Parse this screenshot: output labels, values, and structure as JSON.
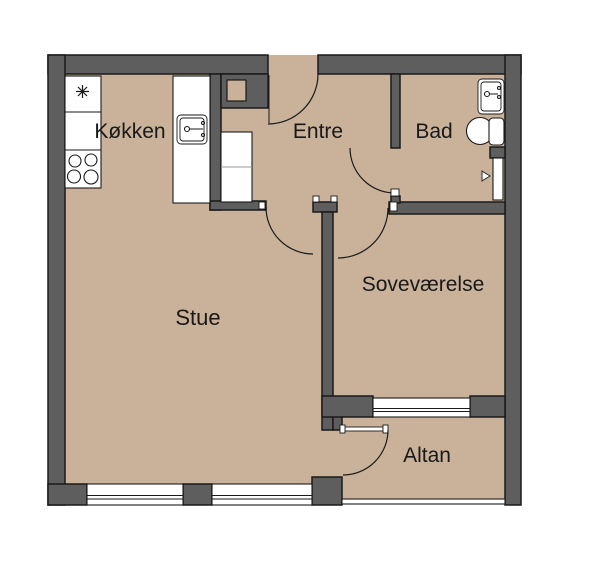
{
  "plan": {
    "type": "apartment-floor-plan",
    "language": "Danish",
    "rooms": [
      {
        "id": "kokken",
        "label": "Køkken"
      },
      {
        "id": "entre",
        "label": "Entre"
      },
      {
        "id": "bad",
        "label": "Bad"
      },
      {
        "id": "stue",
        "label": "Stue"
      },
      {
        "id": "sovevaerelse",
        "label": "Soveværelse"
      },
      {
        "id": "altan",
        "label": "Altan"
      }
    ],
    "fixtures": [
      "fridge-freezer-star-icon",
      "stove-burners-icon",
      "kitchen-sink-icon",
      "kitchen-counters",
      "entre-wardrobe",
      "duct-shaft",
      "entrance-door-swing",
      "bath-door-swing",
      "living-room-door-swing",
      "bedroom-door-swing",
      "balcony-door-swing",
      "bath-sink-icon",
      "toilet-icon",
      "shower-icon",
      "windows",
      "balcony-railing"
    ],
    "colors": {
      "wall": "#5e5e5e",
      "floor": "#c9b299",
      "outline": "#1a1a1a",
      "fixture": "#ffffff",
      "text": "#191919",
      "background": "#ffffff"
    }
  }
}
